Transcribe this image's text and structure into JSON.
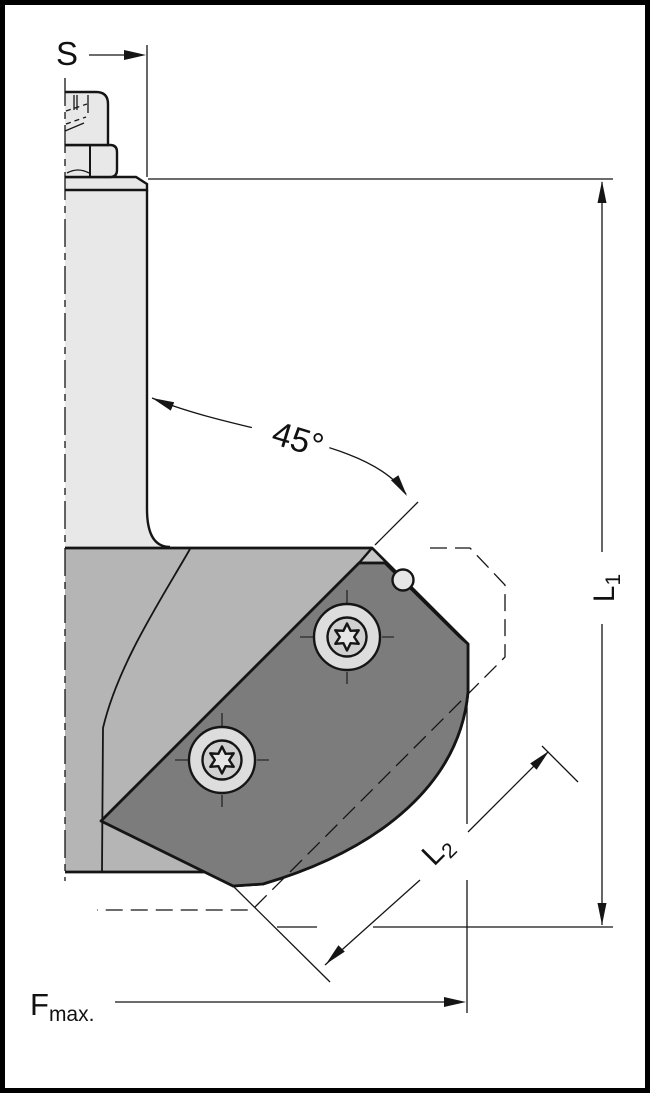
{
  "diagram": {
    "type": "technical-drawing",
    "subject": "45-degree chamfer insert cutter, half section view",
    "dimensions": {
      "shank_diameter": "S",
      "chamfer_angle": "45°",
      "length1": {
        "base": "L",
        "sub": "1"
      },
      "length2": {
        "base": "L",
        "sub": "2"
      },
      "feed_max": {
        "base": "F",
        "sub": "max."
      }
    },
    "colors": {
      "line": "#151515",
      "bg": "#ffffff",
      "shank": "#e8e8e8",
      "body": "#b5b5b5",
      "face": "#c8c8c8",
      "insert": "#7c7c7c",
      "screw": "#dddddd"
    }
  }
}
